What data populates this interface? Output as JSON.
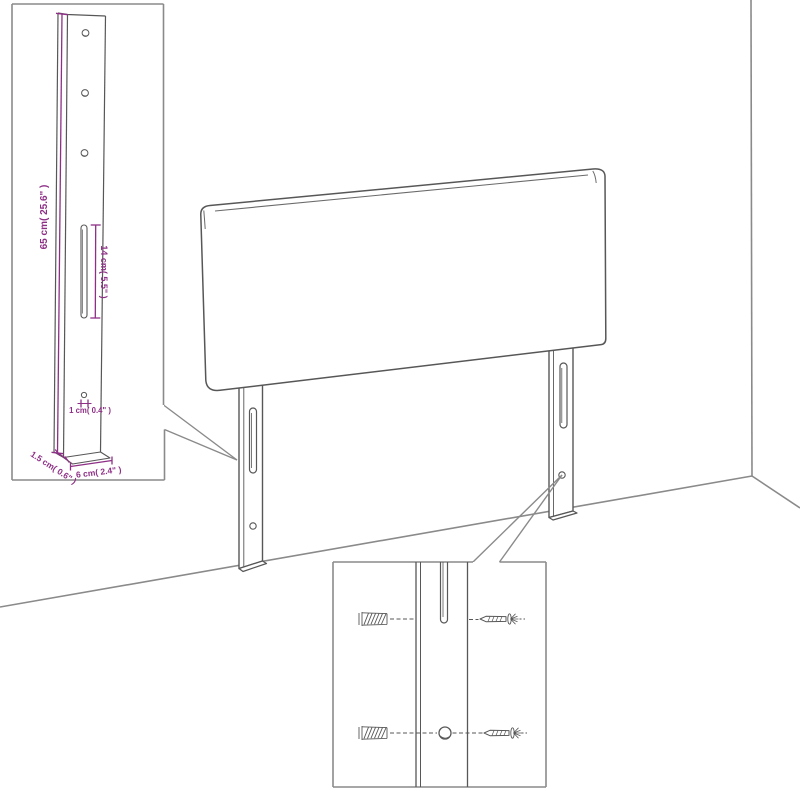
{
  "page": {
    "background": "#ffffff",
    "description": "Technical line-art diagram of an upholstered headboard with two wall-mount legs shown in a room corner, with two zoom detail insets"
  },
  "diagram": {
    "type": "technical-line-drawing",
    "outline_color": "#575757",
    "frame_color": "#8a8a8a",
    "dimension_color": "#8e2f86",
    "insets": {
      "leg_detail": {
        "position": "top-left",
        "labels": {
          "leg_height": "65 cm( 25.6\" )",
          "slot_length": "14 cm( 5.5\" )",
          "hole_diameter": "1 cm( 0.4\" )",
          "leg_thickness": "1.5 cm( 0.6\" )",
          "leg_width": "6 cm( 2.4\" )"
        }
      },
      "mounting_detail": {
        "position": "bottom-right",
        "parts": [
          "wall-anchor",
          "screw",
          "keyhole-slot",
          "mounting-hole"
        ]
      }
    },
    "icons": [
      "wall-anchor-icon",
      "screw-icon"
    ]
  }
}
